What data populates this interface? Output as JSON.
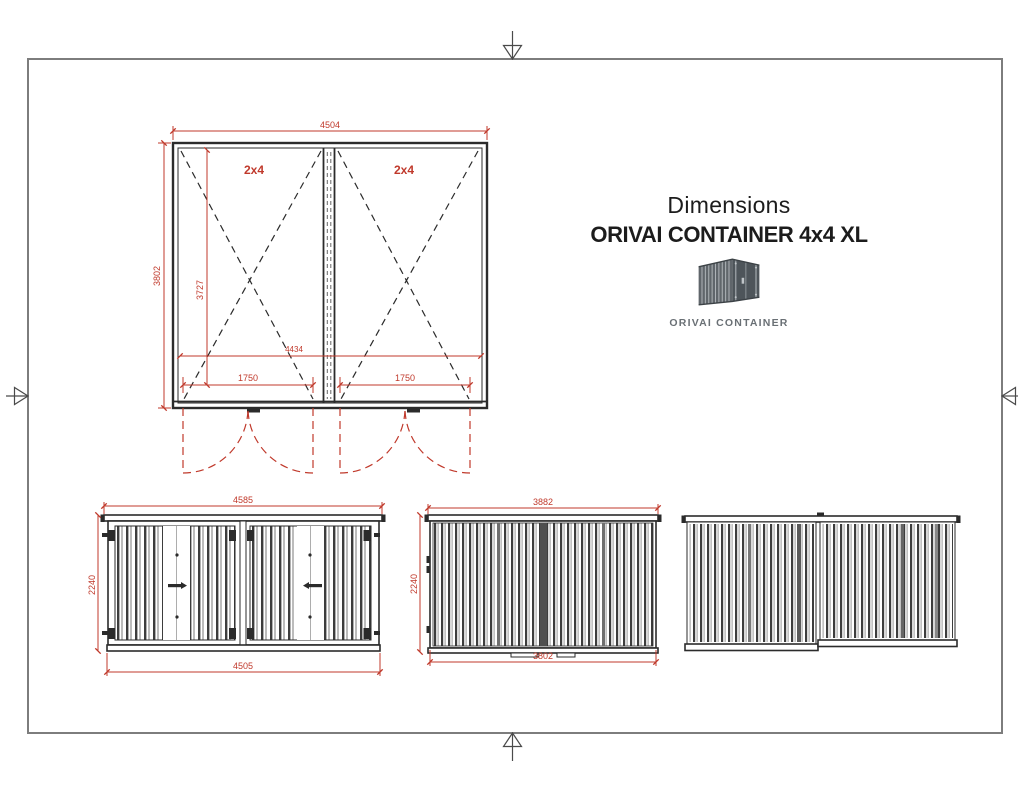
{
  "colors": {
    "dimension_red": "#C0392B",
    "line": "#2b2b2b",
    "border": "#7d7d7d",
    "logo_gray": "#6a7075"
  },
  "header": {
    "subtitle": "Dimensions",
    "title": "ORIVAI CONTAINER 4x4 XL",
    "logo_caption": "ORIVAI CONTAINER"
  },
  "plan_view": {
    "left_cell_label": "2x4",
    "right_cell_label": "2x4",
    "dim_overall_width": "4504",
    "dim_overall_depth": "3802",
    "dim_inner_depth": "3727",
    "dim_inner_width": "4434",
    "dim_left_door_opening": "1750",
    "dim_right_door_opening": "1750"
  },
  "front_elevation": {
    "dim_roof_width": "4585",
    "dim_height": "2240",
    "dim_base_width": "4505"
  },
  "side_elevation": {
    "dim_roof_width": "3882",
    "dim_height": "2240",
    "dim_base_width": "3802"
  }
}
